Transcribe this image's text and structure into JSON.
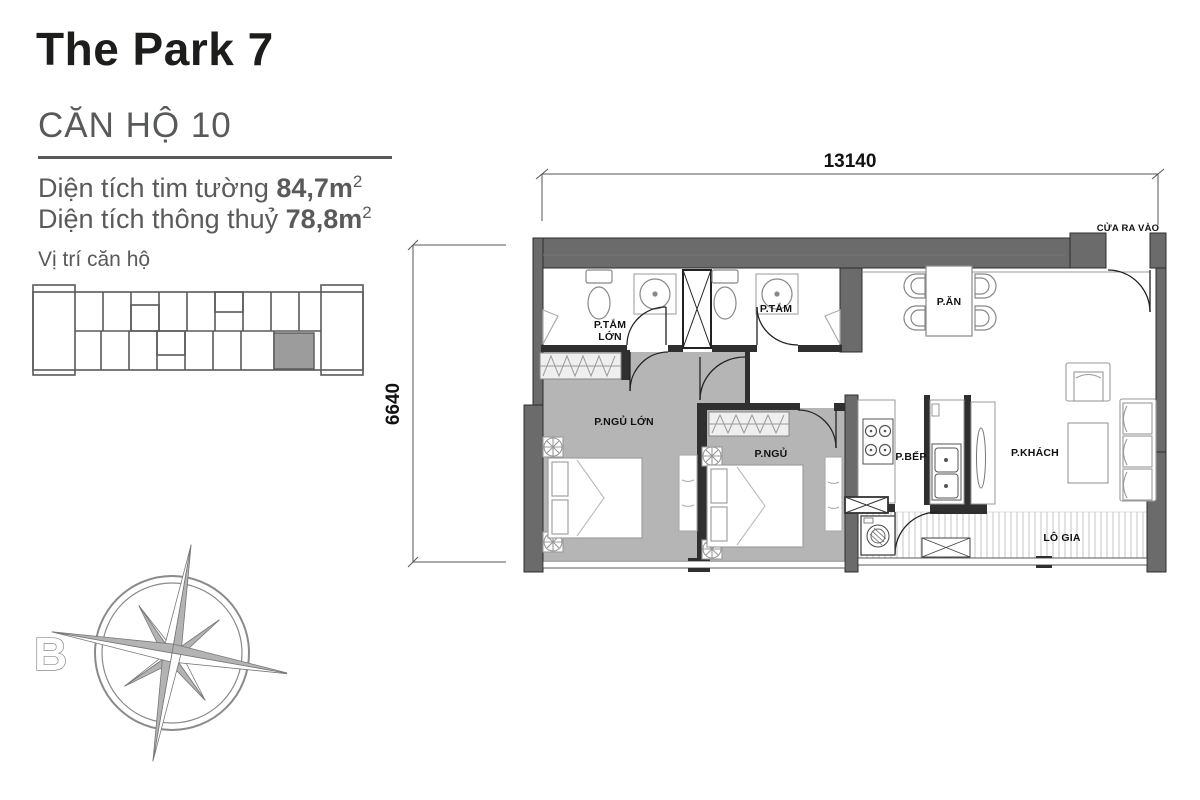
{
  "header": {
    "title": "The Park 7",
    "unit_heading": "CĂN HỘ 10",
    "area1_label": "Diện tích tim tường ",
    "area1_value": "84,7m",
    "area2_label": "Diện tích thông thuỷ ",
    "area2_value": "78,8m",
    "sup": "2",
    "location_label": "Vị trí căn hộ"
  },
  "compass": {
    "north_label": "B"
  },
  "dimensions": {
    "width": "13140",
    "height": "6640"
  },
  "rooms": {
    "bathroom1_line1": "P.TẮM",
    "bathroom1_line2": "LỚN",
    "bathroom2": "P.TẮM",
    "dining": "P.ĂN",
    "bedroom1": "P.NGỦ LỚN",
    "bedroom2": "P.NGỦ",
    "kitchen": "P.BẾP",
    "living": "P.KHÁCH",
    "balcony": "LÔ GIA",
    "entrance": "CỬA RA VÀO"
  },
  "colors": {
    "accent_gray": "#58595b",
    "wall_gray": "#6b6b6b",
    "floor_gray": "#b5b5b5",
    "highlight_unit": "#9c9c9c"
  }
}
